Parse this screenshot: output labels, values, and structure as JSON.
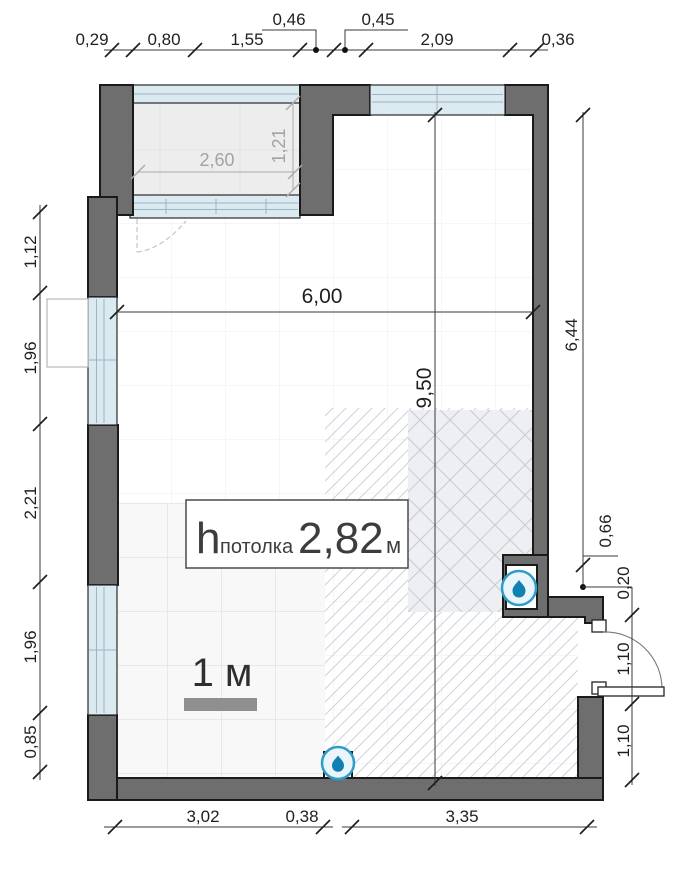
{
  "dims": {
    "top": [
      "0,29",
      "0,80",
      "1,55",
      "0,46",
      "0,45",
      "2,09",
      "0,36"
    ],
    "left": [
      "1,12",
      "1,96",
      "2,21",
      "1,96",
      "0,85"
    ],
    "right": [
      "6,44",
      "0,66",
      "0,20",
      "1,10",
      "1,10"
    ],
    "bottom": [
      "3,02",
      "0,38",
      "3,35"
    ],
    "room_width": "6,00",
    "room_depth": "9,50",
    "balcony_width": "2,60",
    "balcony_depth": "1,21"
  },
  "ceiling": {
    "symbol": "h",
    "subscript": "потолка",
    "value": "2,82",
    "unit": "м"
  },
  "scale": {
    "label": "1 м"
  },
  "icons": {
    "water_drop": "water-drop"
  },
  "colors": {
    "wall": "#6e6e6e",
    "wall_outline": "#1a1a1a",
    "glazing": "#dbe9f1",
    "balcony_floor": "#ededed",
    "hatch_line": "#ccd3db",
    "tile_line": "#dadada",
    "water_drop": "#0f80b0",
    "water_ring": "#2f9dc8",
    "dim_text": "#1f1f1f",
    "gray_dim": "#a3a3a3",
    "scale_bar": "#8f8f8f"
  }
}
